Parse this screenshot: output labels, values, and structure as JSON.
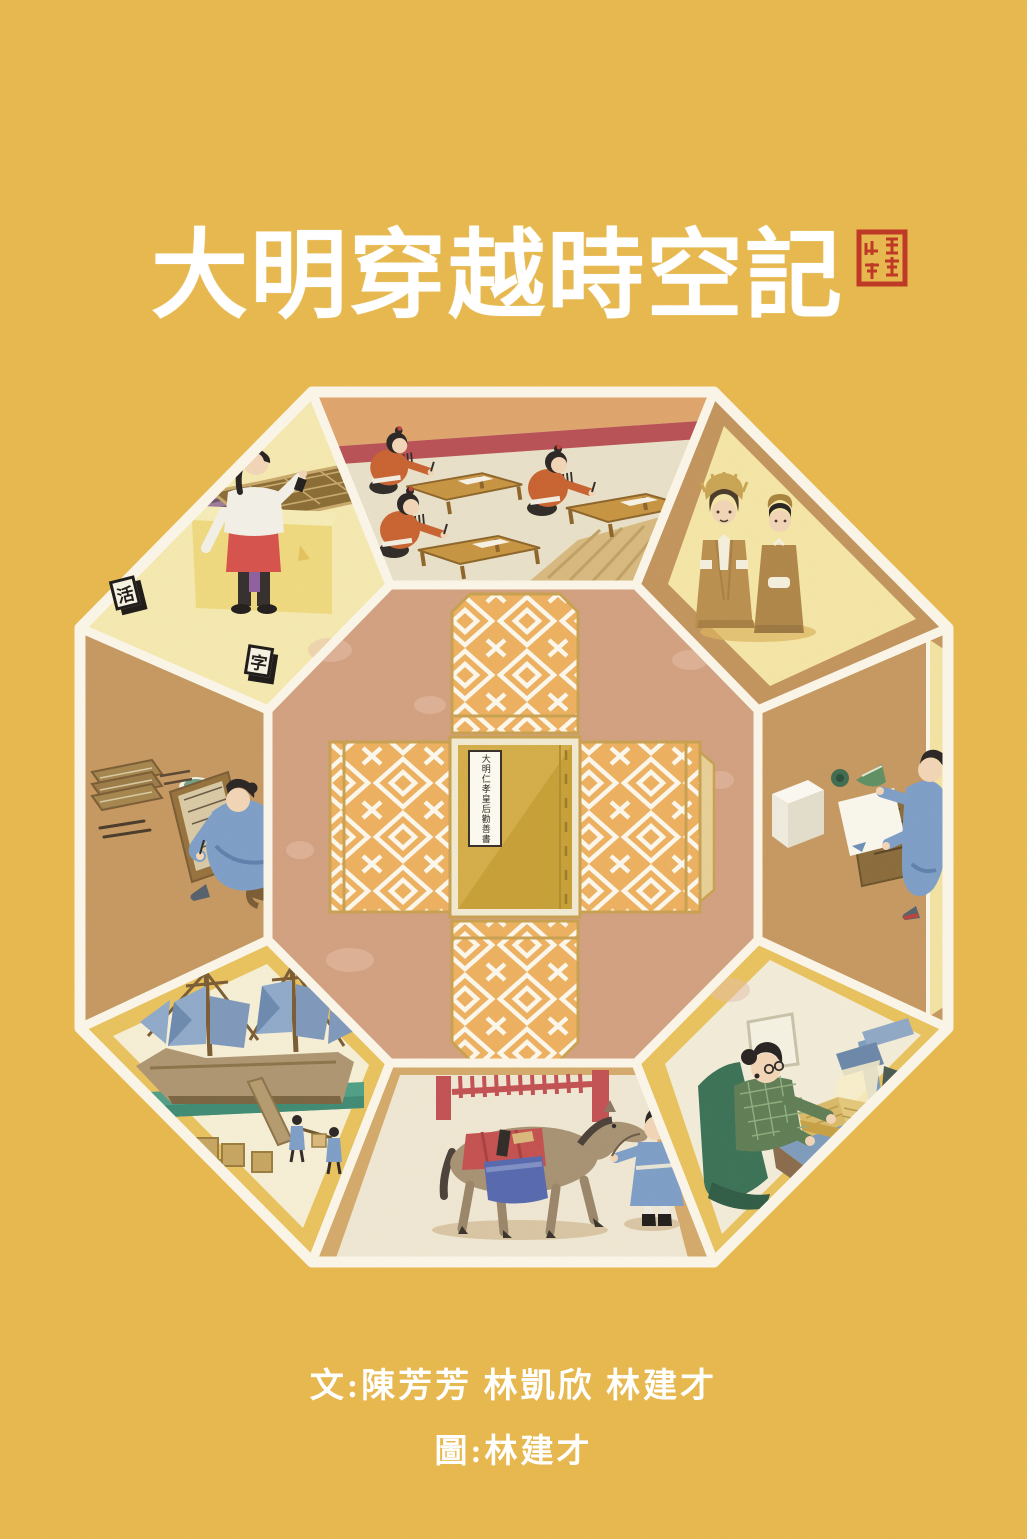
{
  "page": {
    "width": 1027,
    "height": 1539,
    "background_color": "#e8b84c"
  },
  "title": {
    "text": "大明穿越時空記",
    "color": "#ffffff"
  },
  "seal": {
    "icon": "red-seal-stamp",
    "color": "#bf3a26"
  },
  "credits": {
    "written_by": "文:陳芳芳 林凱欣 林建才",
    "illustrated_by": "圖:林建才",
    "color": "#ffffff"
  },
  "center_book": {
    "label": "大明仁孝皇后勸善書"
  },
  "type_blocks": [
    {
      "char": "活"
    },
    {
      "char": "字"
    }
  ],
  "scenes": {
    "center": "unfolded-book-wrapper",
    "top": "imperial-examination-hall",
    "top_left": "movable-type-setting",
    "top_right": "ming-emperor-and-official",
    "left": "manuscript-copying",
    "right": "paper-and-print-lifting",
    "bottom_left": "treasure-ship-loading",
    "bottom": "horse-book-transport",
    "bottom_right": "modern-book-digitisation"
  },
  "palette": {
    "octagon_line": "#fbf6e8",
    "top_panel": "#e9e0c8",
    "top_left_panel": "#f5e9af",
    "top_right_panel": "#c3945c",
    "side_panel_tan": "#c69860",
    "gold_panel": "#e9c25c",
    "bottom_panel": "#d4aa6a",
    "center_panel": "#d2a07f",
    "wrap_orange": "#edb05e",
    "book_gold": "#c79f35",
    "robe_blue": "#7e9ec6",
    "robe_orange": "#c8622f",
    "accent_red": "#b85054"
  }
}
